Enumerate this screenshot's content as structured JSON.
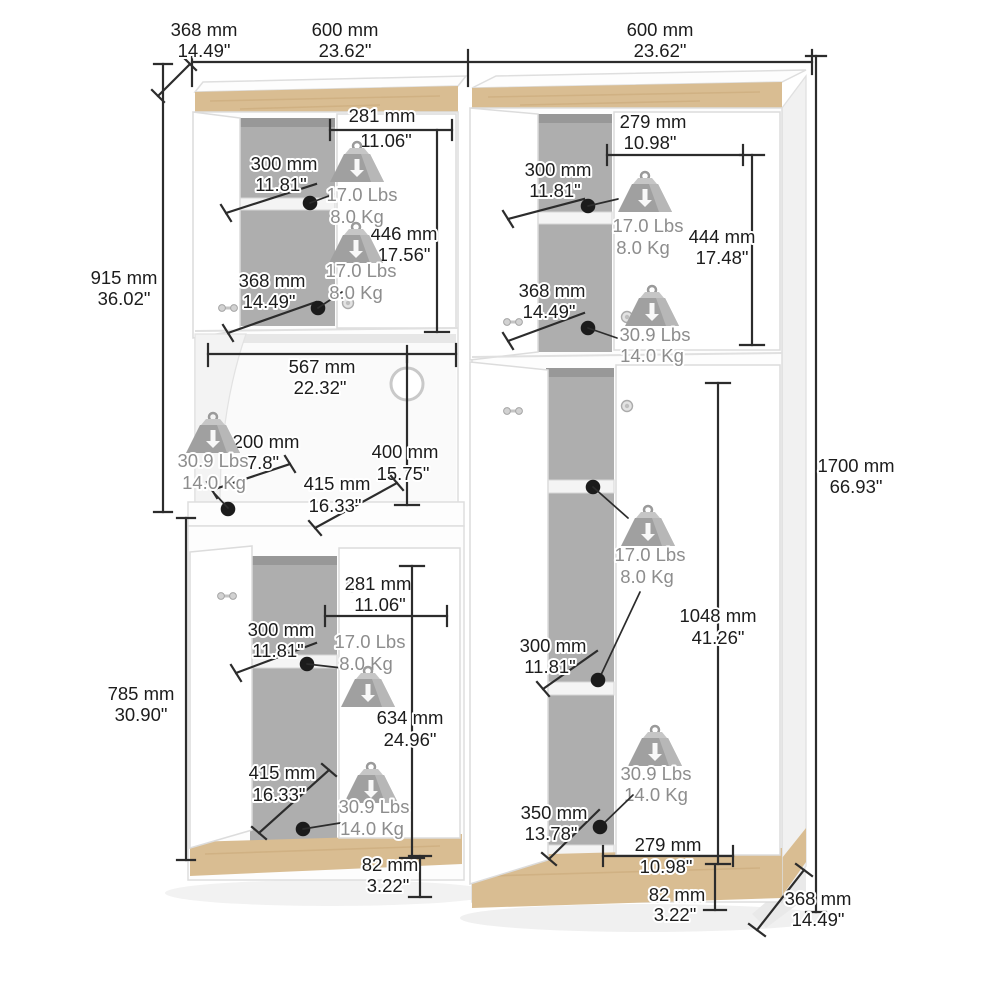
{
  "page": {
    "background": "#ffffff"
  },
  "colors": {
    "wood": "#d9bd92",
    "wood_grain": "#c9a878",
    "dimension_line": "#2c2c2c",
    "dimension_text": "#1c1c1c",
    "capacity_text": "#8d8d8d",
    "interior_shadow": "#aeaeae"
  },
  "dims": {
    "top_depth": {
      "mm": "368 mm",
      "in": "14.49\""
    },
    "left_width": {
      "mm": "600 mm",
      "in": "23.62\""
    },
    "right_width": {
      "mm": "600 mm",
      "in": "23.62\""
    },
    "upper_left_height": {
      "mm": "915 mm",
      "in": "36.02\""
    },
    "lower_left_height": {
      "mm": "785 mm",
      "in": "30.90\""
    },
    "total_height": {
      "mm": "1700 mm",
      "in": "66.93\""
    },
    "tl_inner_width": {
      "mm": "281 mm",
      "in": "11.06\""
    },
    "tl_shelf_depth": {
      "mm": "300 mm",
      "in": "11.81\""
    },
    "tl_inner_height": {
      "mm": "446 mm",
      "in": "17.56\""
    },
    "tl_shelf_width": {
      "mm": "368 mm",
      "in": "14.49\""
    },
    "tr_inner_width": {
      "mm": "279 mm",
      "in": "10.98\""
    },
    "tr_shelf_depth": {
      "mm": "300 mm",
      "in": "11.81\""
    },
    "tr_inner_height": {
      "mm": "444 mm",
      "in": "17.48\""
    },
    "tr_shelf_width": {
      "mm": "368 mm",
      "in": "14.49\""
    },
    "hutch_width": {
      "mm": "567 mm",
      "in": "22.32\""
    },
    "hutch_side_depth": {
      "mm": "200 mm",
      "in": "7.8\""
    },
    "hutch_height": {
      "mm": "400 mm",
      "in": "15.75\""
    },
    "hutch_shelf_diag": {
      "mm": "415 mm",
      "in": "16.33\""
    },
    "bl_inner_width": {
      "mm": "281 mm",
      "in": "11.06\""
    },
    "bl_shelf_depth": {
      "mm": "300 mm",
      "in": "11.81\""
    },
    "bl_inner_height": {
      "mm": "634 mm",
      "in": "24.96\""
    },
    "bl_shelf_diag": {
      "mm": "415 mm",
      "in": "16.33\""
    },
    "bl_plinth_height": {
      "mm": "82 mm",
      "in": "3.22\""
    },
    "br_shelf_depth": {
      "mm": "300 mm",
      "in": "11.81\""
    },
    "br_inner_height": {
      "mm": "1048 mm",
      "in": "41.26\""
    },
    "br_bottom_gap": {
      "mm": "350 mm",
      "in": "13.78\""
    },
    "br_inner_width": {
      "mm": "279 mm",
      "in": "10.98\""
    },
    "br_plinth_height": {
      "mm": "82 mm",
      "in": "3.22\""
    },
    "base_depth": {
      "mm": "368 mm",
      "in": "14.49\""
    }
  },
  "capacities": {
    "tl_upper": {
      "lbs": "17.0 Lbs",
      "kg": "8.0 Kg"
    },
    "tl_lower": {
      "lbs": "17.0 Lbs",
      "kg": "8.0 Kg"
    },
    "tr_upper": {
      "lbs": "17.0 Lbs",
      "kg": "8.0 Kg"
    },
    "tr_lower": {
      "lbs": "30.9 Lbs",
      "kg": "14.0 Kg"
    },
    "hutch": {
      "lbs": "30.9 Lbs",
      "kg": "14.0 Kg"
    },
    "bl_upper": {
      "lbs": "17.0 Lbs",
      "kg": "8.0 Kg"
    },
    "bl_lower": {
      "lbs": "30.9 Lbs",
      "kg": "14.0 Kg"
    },
    "br_upper": {
      "lbs": "17.0 Lbs",
      "kg": "8.0 Kg"
    },
    "br_lower": {
      "lbs": "30.9 Lbs",
      "kg": "14.0 Kg"
    }
  }
}
